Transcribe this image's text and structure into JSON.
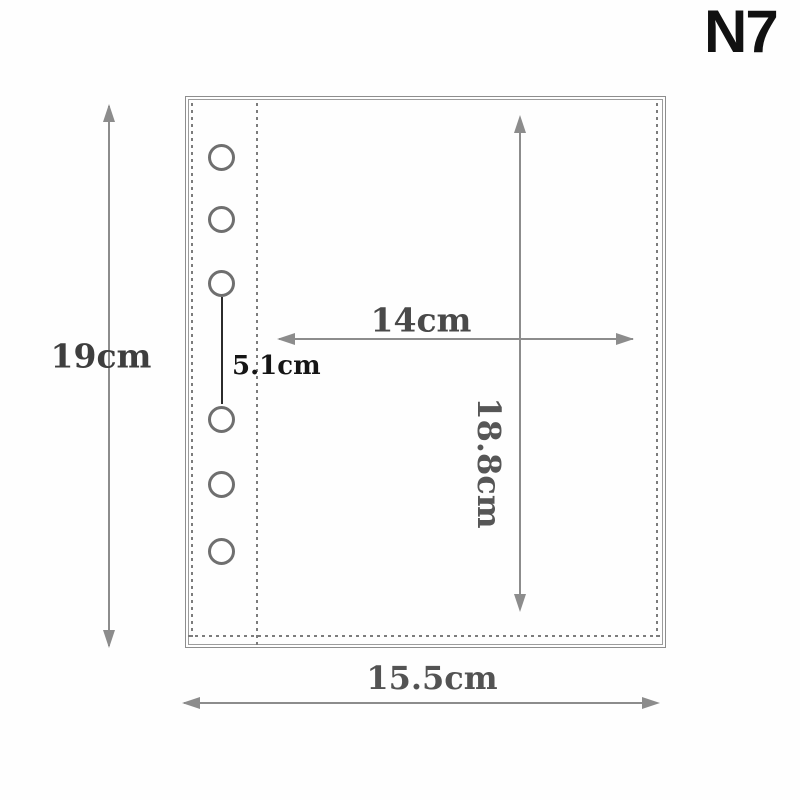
{
  "product": {
    "model": "N7"
  },
  "pocket": {
    "hole_count": 6,
    "measurements": {
      "outer_height": "19cm",
      "outer_width": "15.5cm",
      "inner_width": "14cm",
      "inner_height": "18.8cm",
      "hole_gap": "5.1cm"
    },
    "colors": {
      "model_text": "#111111",
      "dimension_line": "#8c8c8c",
      "dimension_label": "#4c4c4c",
      "hole_gap_label": "#151515",
      "pocket_outline": "#8d8d8d",
      "stitch_dash": "#7c7c7c",
      "hole_ring": "#6f6f6f",
      "background": "#fefefe"
    }
  }
}
